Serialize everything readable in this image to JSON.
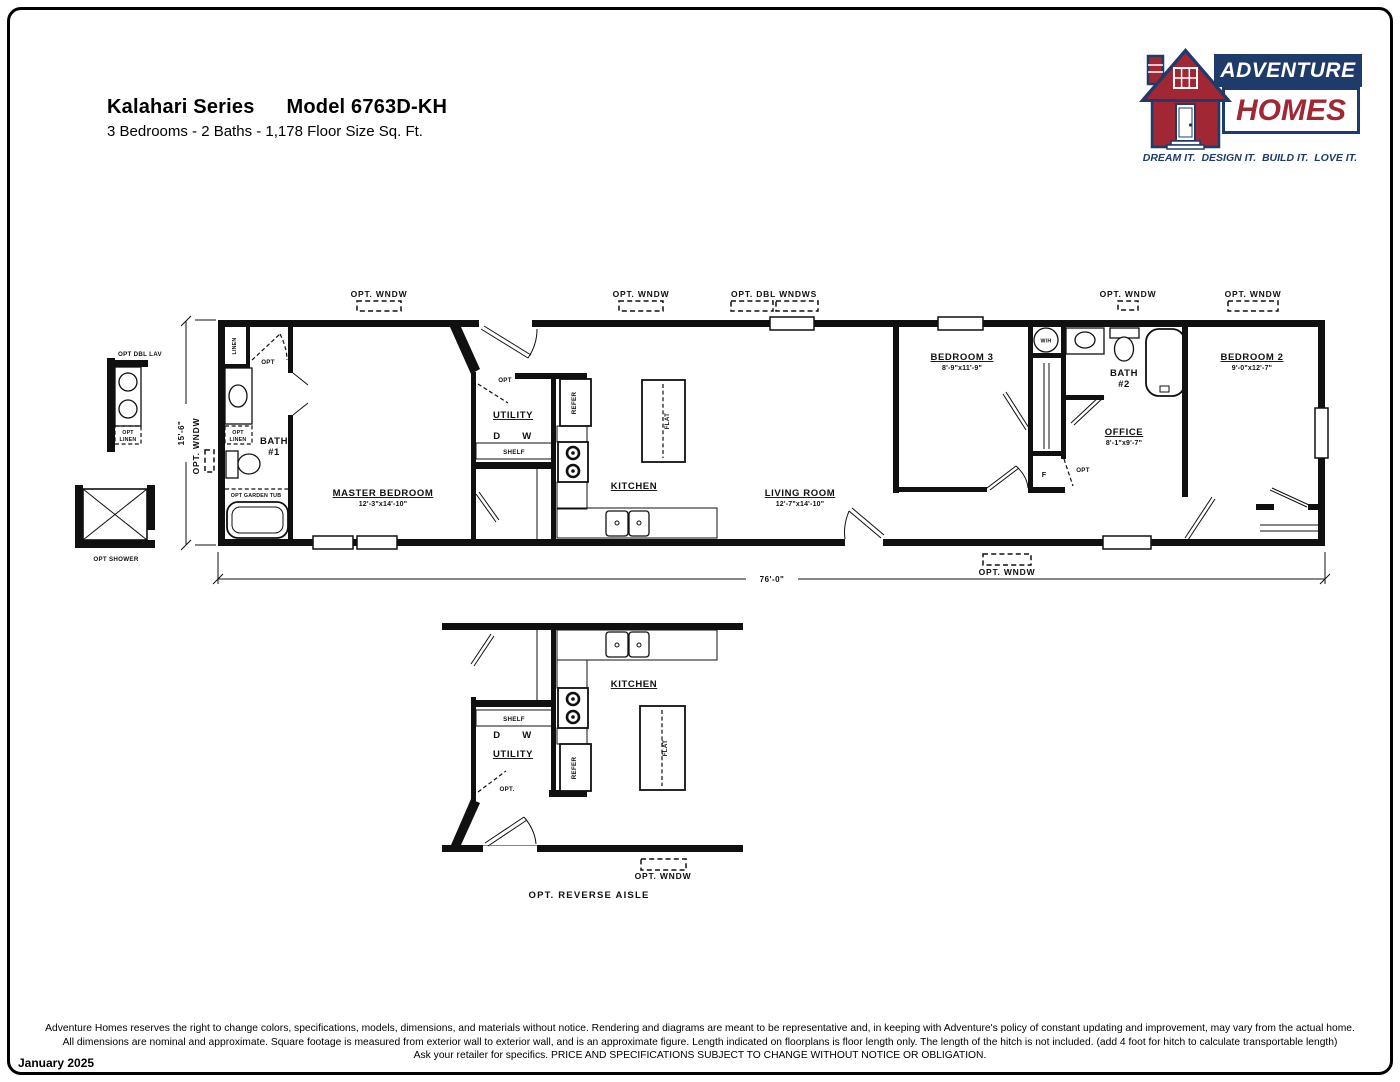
{
  "header": {
    "series": "Kalahari Series",
    "model": "Model 6763D-KH",
    "subtitle": "3 Bedrooms - 2 Baths - 1,178 Floor Size Sq. Ft."
  },
  "logo": {
    "adventure": "ADVENTURE",
    "homes": "HOMES",
    "tagline": "DREAM IT.  DESIGN IT.  BUILD IT.  LOVE IT.",
    "navy": "#1f3b69",
    "red": "#a02733"
  },
  "labels": {
    "opt_wndw": "OPT. WNDW",
    "opt_dbl_wndws": "OPT. DBL WNDWS",
    "opt_dbl_lav": "OPT DBL LAV",
    "opt_shower": "OPT SHOWER",
    "opt_garden_tub": "OPT GARDEN TUB",
    "opt": "OPT",
    "opt_dot": "OPT.",
    "linen": "LINEN",
    "shelf": "SHELF",
    "refer": "REFER",
    "flat": "FLAT",
    "d": "D",
    "w": "W",
    "wh": "W/H",
    "f": "F"
  },
  "dims": {
    "length": "76'-0\"",
    "width": "15'-6\""
  },
  "rooms": {
    "master": {
      "name": "MASTER BEDROOM",
      "size": "12'-3\"x14'-10\""
    },
    "bath1": {
      "name": "BATH",
      "num": "#1"
    },
    "utility": {
      "name": "UTILITY"
    },
    "kitchen": {
      "name": "KITCHEN"
    },
    "living": {
      "name": "LIVING ROOM",
      "size": "12'-7\"x14'-10\""
    },
    "bed3": {
      "name": "BEDROOM 3",
      "size": "8'-9\"x11'-9\""
    },
    "bath2": {
      "name": "BATH",
      "num": "#2"
    },
    "office": {
      "name": "OFFICE",
      "size": "8'-1\"x9'-7\""
    },
    "bed2": {
      "name": "BEDROOM 2",
      "size": "9'-0\"x12'-7\""
    }
  },
  "alt_plan": {
    "caption": "OPT. REVERSE AISLE"
  },
  "footer": {
    "line1": "Adventure Homes reserves the right to change colors, specifications, models, dimensions, and materials without notice. Rendering and diagrams are meant to be representative and, in keeping with Adventure's policy of constant updating and improvement, may vary from the actual home.",
    "line2": "All dimensions are nominal and approximate. Square footage is measured from exterior wall to exterior wall, and is an approximate figure. Length indicated on floorplans is floor length only. The length of the hitch is not included. (add 4 foot for hitch to calculate transportable length)",
    "line3": "Ask your retailer for specifics. PRICE AND SPECIFICATIONS SUBJECT TO CHANGE WITHOUT NOTICE OR OBLIGATION.",
    "date": "January 2025"
  }
}
